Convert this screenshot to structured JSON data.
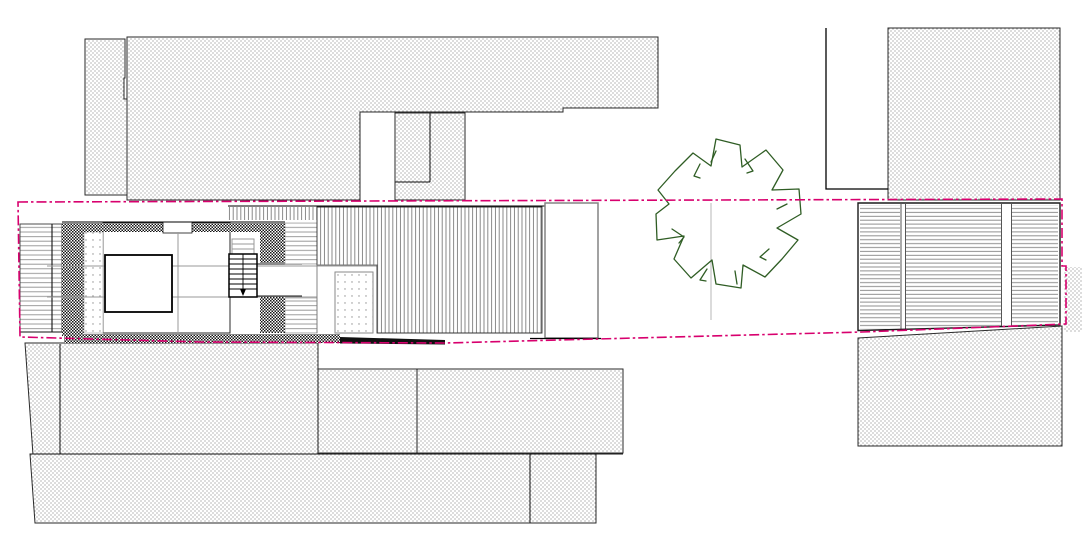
{
  "document": {
    "kind": "architectural-site-plan",
    "view": "top-down plan (CAD drawing)",
    "visible_text": "none"
  },
  "colors": {
    "background": "#FFFFFF",
    "outline": "#1A1A1A",
    "hatch_gray": "#8C8C8C",
    "boundary_magenta": "#D8006E",
    "tree_green": "#2F5D24"
  },
  "elements": {
    "boundary": "parcel-boundary (magenta dash-dot polygon)",
    "tree": "deciduous-tree-canopy symbol",
    "north_buildings": [
      "neighbor-northwest-wing",
      "neighbor-north-block",
      "north-annex",
      "neighbor-northeast-block",
      "courtyard-wall"
    ],
    "main_house": [
      "west-terrace-deck",
      "checker-wall-bands",
      "gravel-strip",
      "west-rooms",
      "central-stair",
      "corridor",
      "east-plank-deck",
      "striped-roof-deck",
      "dotted-patio",
      "east-white-room",
      "garage-east"
    ],
    "south_buildings": [
      "neighbor-south-a",
      "neighbor-south-b",
      "neighbor-south-c",
      "neighbor-southeast-block",
      "east-edge-strip"
    ]
  },
  "hatches": [
    "stipple-dots",
    "vertical-stripes",
    "horizontal-planks",
    "checkerboard",
    "sparse-dots"
  ]
}
